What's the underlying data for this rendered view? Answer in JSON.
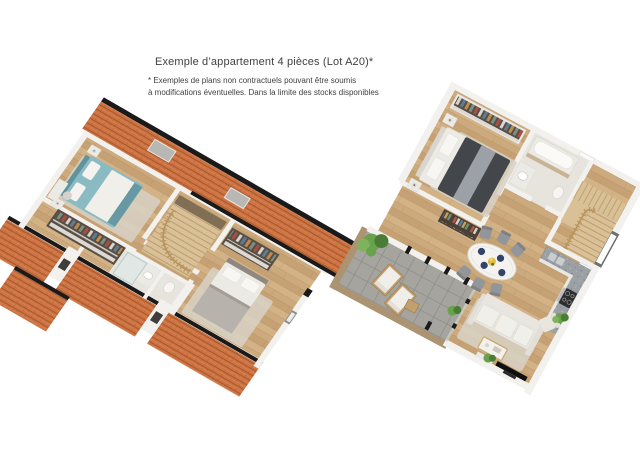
{
  "header": {
    "title": "Exemple d’appartement 4 pièces (Lot A20)*",
    "disclaimer_line1": "* Exemples de plans non contractuels pouvant être soumis",
    "disclaimer_line2": "à modifications éventuelles. Dans la limite des stocks disponibles"
  },
  "palette": {
    "bg": "#ffffff",
    "text": "#414141",
    "roof": "#cd7342",
    "roof_dark": "#a3552b",
    "roof_light": "#e2936a",
    "ridge": "#1a1a1a",
    "wall": "#f2f1ee",
    "wall_shade": "#d7d5d0",
    "floor": "#ccaa7d",
    "floor_dark": "#b08d60",
    "bath_floor": "#e7e4de",
    "terrace": "#a6a49f",
    "terrace_line": "#8f8d88",
    "bed_teal": "#8abbc3",
    "bed_teal_dark": "#5f939e",
    "bed_dark": "#43474c",
    "bed_gray": "#9ba1a7",
    "white_furn": "#eceae5",
    "sofa": "#e9e6e0",
    "stair_wood": "#d9c096",
    "stair_rail": "#b8945f",
    "counter": "#9ba0a4",
    "appliance": "#2d2d2d",
    "plant": "#6aa14c",
    "plant_dark": "#4b7c35",
    "wood_furn": "#c1a06d",
    "navy": "#31426b",
    "yellow": "#e7bb3e",
    "rug": "#d8d2c6",
    "closet_bg": "#574e45",
    "glass": "#c5d6d8"
  }
}
